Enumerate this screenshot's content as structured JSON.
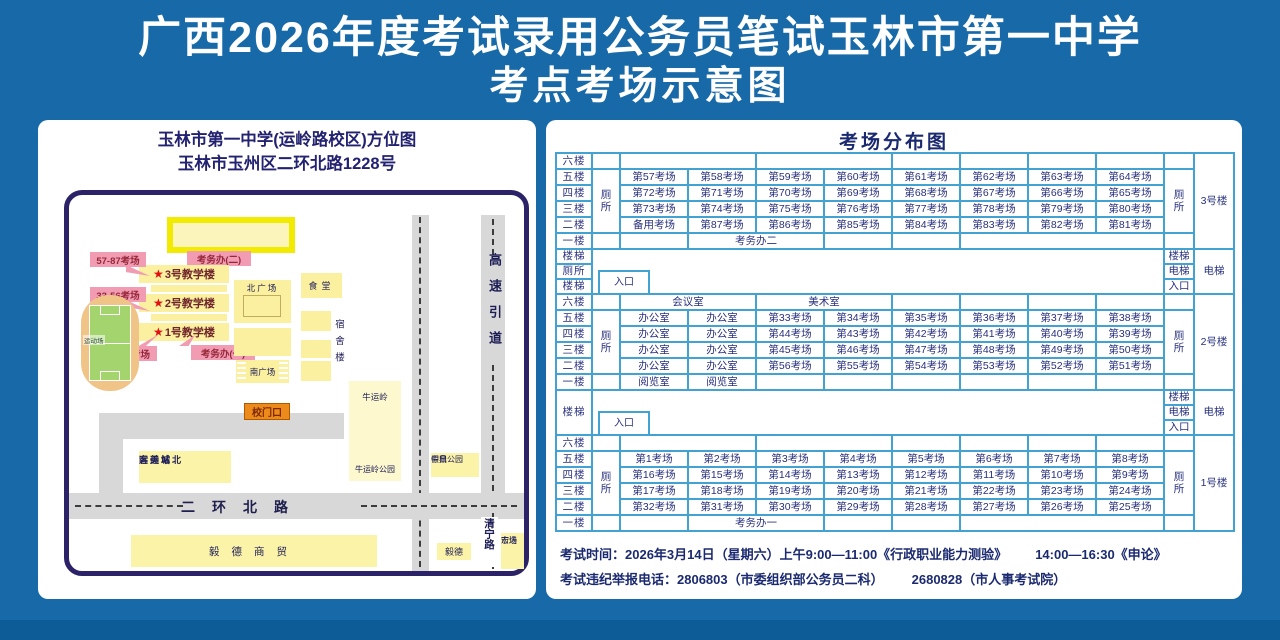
{
  "title_line1": "广西2026年度考试录用公务员笔试玉林市第一中学",
  "title_line2": "考点考场示意图",
  "map": {
    "heading1": "玉林市第一中学(运岭路校区)方位图",
    "heading2": "玉林市玉州区二环北路1228号",
    "star": "★",
    "rooms_57_87": "57-87考场",
    "rooms_33_56": "33-56考场",
    "rooms_1_32": "1-32考场",
    "building3": "3号教学楼",
    "building2": "2号教学楼",
    "building1": "1号教学楼",
    "kaowuban2": "考务办(二)",
    "kaowuban1": "考务办(一)",
    "north_square": "北广场",
    "south_square": "南广场",
    "canteen": "食堂",
    "dorm": "宿舍楼",
    "field": "运动场",
    "niuyunling": "牛运岭",
    "niuyunling_park": "牛运岭公园",
    "gate": "校门口",
    "bus1": "运美城北",
    "bus2": "客运站",
    "zhongding1": "中鼎公园",
    "zhongding2": "假日",
    "erhuan": "二环北路",
    "highway": "高速引道",
    "qingning": "清宁路",
    "yide_trade": "毅德商贸",
    "yide": "毅德",
    "hongjin1": "宏进",
    "hongjin2": "市场"
  },
  "distribution": {
    "title": "考场分布图",
    "sections": [
      {
        "building": "3号楼",
        "toilet": "厕所",
        "rows": [
          {
            "floor": "六楼",
            "cells": [
              {
                "t": "",
                "s": 2
              },
              {
                "t": "",
                "s": 2
              },
              {
                "t": ""
              },
              {
                "t": ""
              },
              {
                "t": ""
              },
              {
                "t": ""
              }
            ]
          },
          {
            "floor": "五楼",
            "cells": [
              "第57考场",
              "第58考场",
              "第59考场",
              "第60考场",
              "第61考场",
              "第62考场",
              "第63考场",
              "第64考场"
            ]
          },
          {
            "floor": "四楼",
            "cells": [
              "第72考场",
              "第71考场",
              "第70考场",
              "第69考场",
              "第68考场",
              "第67考场",
              "第66考场",
              "第65考场"
            ]
          },
          {
            "floor": "三楼",
            "cells": [
              "第73考场",
              "第74考场",
              "第75考场",
              "第76考场",
              "第77考场",
              "第78考场",
              "第79考场",
              "第80考场"
            ]
          },
          {
            "floor": "二楼",
            "cells": [
              "备用考场",
              "第87考场",
              "第86考场",
              "第85考场",
              "第84考场",
              "第83考场",
              "第82考场",
              "第81考场"
            ]
          },
          {
            "floor": "一楼",
            "cells": [
              {
                "t": ""
              },
              {
                "t": "考务办二",
                "s": 2
              },
              {
                "t": ""
              },
              {
                "t": ""
              },
              {
                "t": "",
                "s": 3
              }
            ]
          }
        ]
      },
      {
        "separator": {
          "left": [
            "楼梯",
            "厕所",
            "楼梯"
          ],
          "right": [
            "楼梯",
            "电梯",
            "入口"
          ],
          "corner": "电梯",
          "entrance": "入口"
        }
      },
      {
        "building": "2号楼",
        "toilet": "厕所",
        "rows": [
          {
            "floor": "六楼",
            "cells": [
              {
                "t": "会议室",
                "s": 2
              },
              {
                "t": "美术室",
                "s": 2
              },
              {
                "t": ""
              },
              {
                "t": ""
              },
              {
                "t": ""
              },
              {
                "t": ""
              }
            ]
          },
          {
            "floor": "五楼",
            "cells": [
              "办公室",
              "办公室",
              "第33考场",
              "第34考场",
              "第35考场",
              "第36考场",
              "第37考场",
              "第38考场"
            ]
          },
          {
            "floor": "四楼",
            "cells": [
              "办公室",
              "办公室",
              "第44考场",
              "第43考场",
              "第42考场",
              "第41考场",
              "第40考场",
              "第39考场"
            ]
          },
          {
            "floor": "三楼",
            "cells": [
              "办公室",
              "办公室",
              "第45考场",
              "第46考场",
              "第47考场",
              "第48考场",
              "第49考场",
              "第50考场"
            ]
          },
          {
            "floor": "二楼",
            "cells": [
              "办公室",
              "办公室",
              "第56考场",
              "第55考场",
              "第54考场",
              "第53考场",
              "第52考场",
              "第51考场"
            ]
          },
          {
            "floor": "一楼",
            "cells": [
              "阅览室",
              "阅览室",
              "",
              "",
              "",
              "",
              "",
              ""
            ]
          }
        ]
      },
      {
        "separator": {
          "left": [
            "楼梯"
          ],
          "right": [
            "楼梯",
            "电梯",
            "入口"
          ],
          "corner": "电梯",
          "entrance": "入口"
        }
      },
      {
        "building": "1号楼",
        "toilet": "厕所",
        "rows": [
          {
            "floor": "六楼",
            "cells": [
              {
                "t": "",
                "s": 2
              },
              {
                "t": "",
                "s": 2
              },
              {
                "t": ""
              },
              {
                "t": ""
              },
              {
                "t": ""
              },
              {
                "t": ""
              }
            ]
          },
          {
            "floor": "五楼",
            "cells": [
              "第1考场",
              "第2考场",
              "第3考场",
              "第4考场",
              "第5考场",
              "第6考场",
              "第7考场",
              "第8考场"
            ]
          },
          {
            "floor": "四楼",
            "cells": [
              "第16考场",
              "第15考场",
              "第14考场",
              "第13考场",
              "第12考场",
              "第11考场",
              "第10考场",
              "第9考场"
            ]
          },
          {
            "floor": "三楼",
            "cells": [
              "第17考场",
              "第18考场",
              "第19考场",
              "第20考场",
              "第21考场",
              "第22考场",
              "第23考场",
              "第24考场"
            ]
          },
          {
            "floor": "二楼",
            "cells": [
              "第32考场",
              "第31考场",
              "第30考场",
              "第29考场",
              "第28考场",
              "第27考场",
              "第26考场",
              "第25考场"
            ]
          },
          {
            "floor": "一楼",
            "cells": [
              {
                "t": ""
              },
              {
                "t": "考务办一",
                "s": 2
              },
              {
                "t": ""
              },
              {
                "t": ""
              },
              {
                "t": "",
                "s": 3
              }
            ]
          }
        ]
      }
    ]
  },
  "notes": {
    "line1_label": "考试时间：",
    "line1_a": "2026年3月14日（星期六）上午9:00—11:00《行政职业能力测验》",
    "line1_b": "14:00—16:30《申论》",
    "line2_label": "考试违纪举报电话：",
    "line2_a": "2806803（市委组织部公务员二科）",
    "line2_b": "2680828（市人事考试院）"
  },
  "colors": {
    "background_blue": "#1769a8",
    "table_border_blue": "#42a3d3",
    "navy_text": "#1b2a70",
    "map_border_navy": "#2b2268",
    "building_yellow": "#faf0a0",
    "ring_yellow": "#f2ea00",
    "pink_label": "#f19cb3",
    "star_red": "#e01010",
    "gate_orange": "#ec8a1b",
    "road_gray": "#d8d8d8",
    "field_green": "#a3d46e",
    "track_tan": "#f0c387"
  }
}
